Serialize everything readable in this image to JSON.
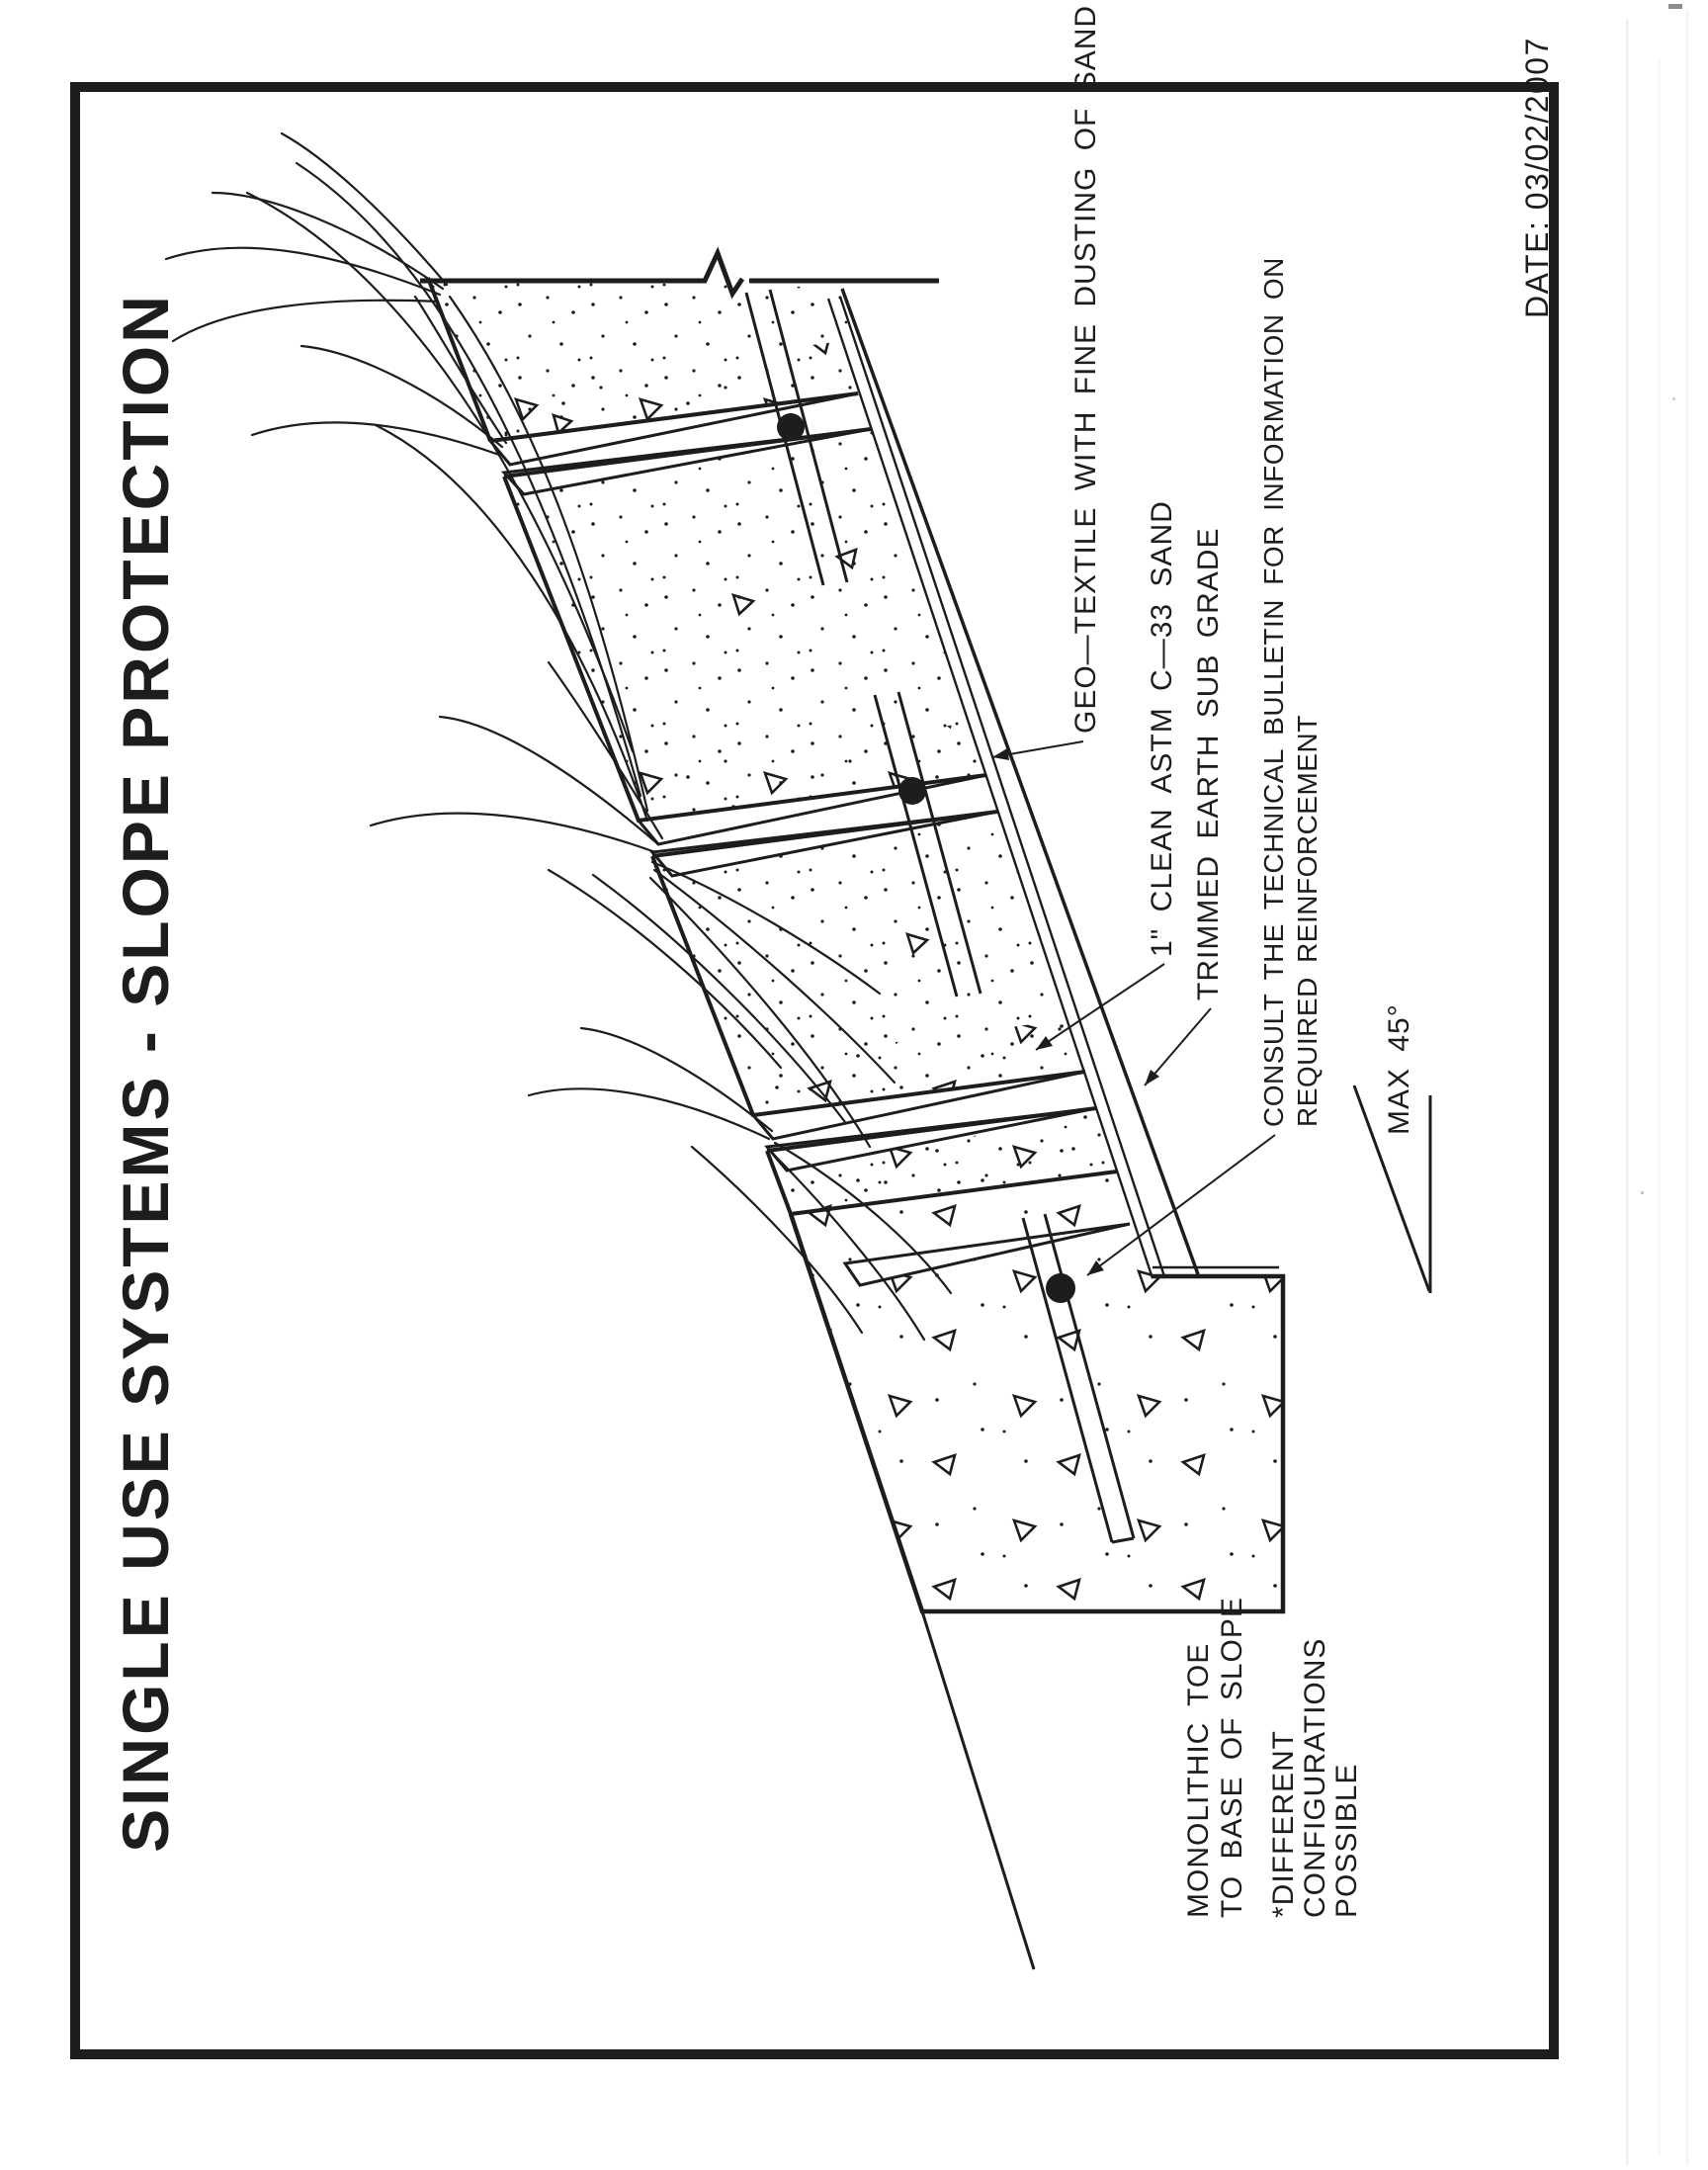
{
  "page": {
    "title": "SINGLE USE SYSTEMS  -  SLOPE PROTECTION",
    "date_label": "DATE: 03/02/2007"
  },
  "annotations": {
    "geotextile": "GEO—TEXTILE WITH FINE DUSTING OF SAND",
    "sand": "1\" CLEAN ASTM C—33 SAND",
    "subgrade": "TRIMMED EARTH SUB GRADE",
    "consult_line1": "CONSULT THE TECHNICAL BULLETIN FOR INFORMATION ON",
    "consult_line2": "REQUIRED REINFORCEMENT",
    "max_angle": "MAX 45°",
    "toe_line1": "MONOLITHIC TOE",
    "toe_line2": "TO BASE OF SLOPE",
    "note_line1": "*DIFFERENT",
    "note_line2": "CONFIGURATIONS",
    "note_line3": "POSSIBLE"
  },
  "colors": {
    "ink": "#1d1d1d",
    "paper": "#ffffff"
  }
}
